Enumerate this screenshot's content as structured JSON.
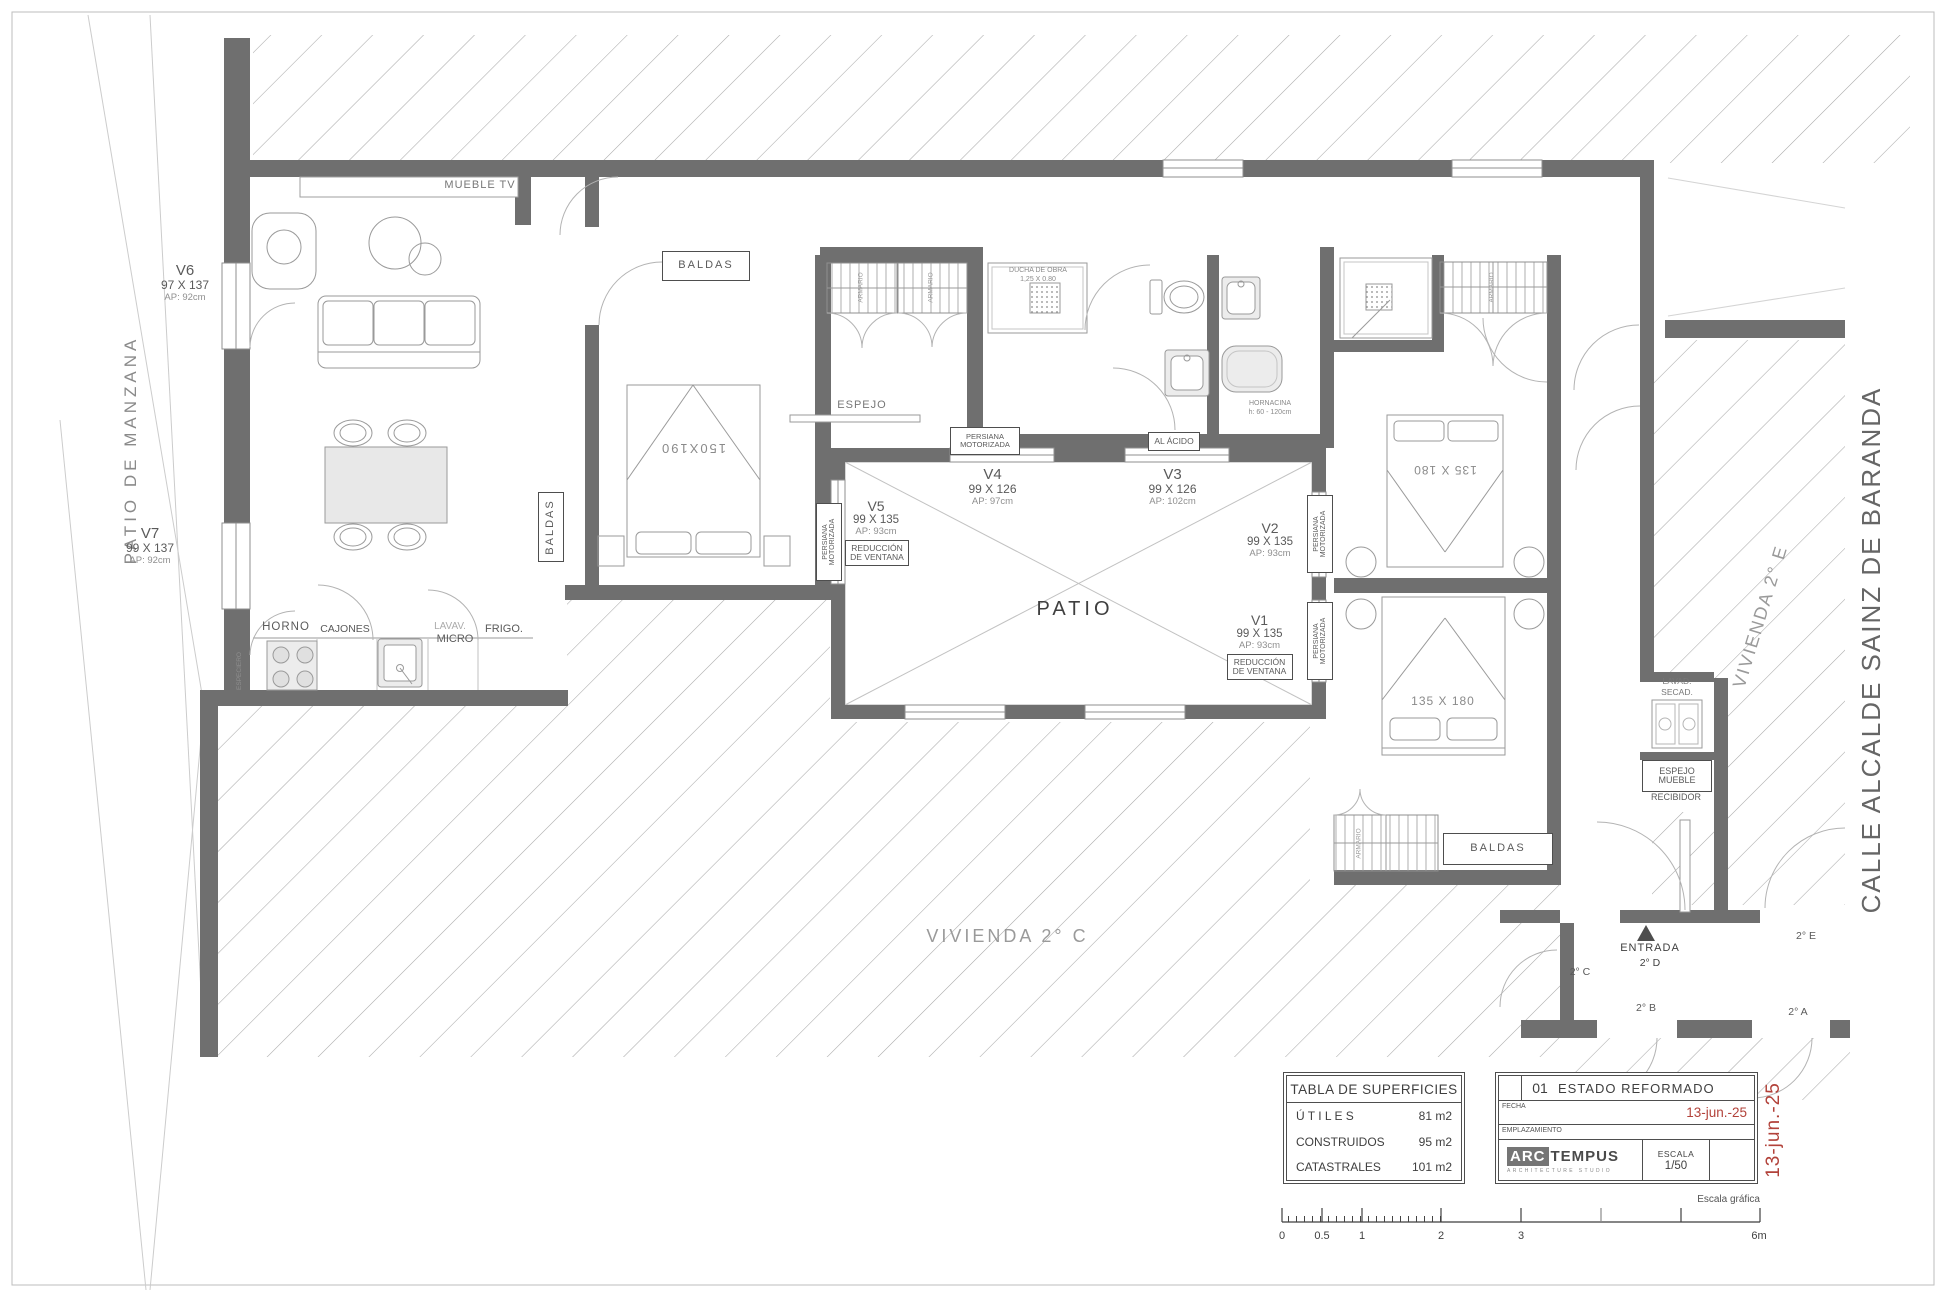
{
  "labels": {
    "patio_manzana": "PATIO DE MANZANA",
    "vivienda_c": "VIVIENDA 2° C",
    "vivienda_e": "VIVIENDA 2° E",
    "calle": "CALLE ALCALDE SAINZ DE BARANDA",
    "mueble_tv": "MUEBLE TV",
    "baldas": "BALDAS",
    "espejo": "ESPEJO",
    "patio": "PATIO",
    "entrada": "ENTRADA",
    "entrada_unit": "2° D",
    "unit_c": "2° C",
    "unit_e": "2° E",
    "unit_b": "2° B",
    "unit_a": "2° A",
    "armario": "ARMARIO",
    "especiero": "ESPECIERO",
    "horno": "HORNO",
    "cajones": "CAJONES",
    "lavav": "LAVAV.",
    "micro": "MICRO",
    "frigo": "FRIGO.",
    "bed_150": "150X190",
    "bed_135": "135 X 180",
    "ducha": "DUCHA DE OBRA",
    "ducha_dim": "1,25 X 0.80",
    "al_acido": "AL ÁCIDO",
    "hornacina": "HORNACINA",
    "hornacina_h": "h: 60 - 120cm",
    "persiana1": "PERSIANA",
    "persiana2": "MOTORIZADA",
    "reduccion1": "REDUCCIÓN",
    "reduccion2": "DE VENTANA",
    "lavad": "LAVAD.",
    "secad": "SECAD.",
    "espejo_mueble1": "ESPEJO",
    "espejo_mueble2": "MUEBLE",
    "recibidor": "RECIBIDOR"
  },
  "windows": {
    "v6": {
      "id": "V6",
      "dim": "97 X 137",
      "ap": "AP: 92cm"
    },
    "v7": {
      "id": "V7",
      "dim": "99 X 137",
      "ap": "AP: 92cm"
    },
    "v5": {
      "id": "V5",
      "dim": "99 X 135",
      "ap": "AP: 93cm"
    },
    "v4": {
      "id": "V4",
      "dim": "99 X 126",
      "ap": "AP: 97cm"
    },
    "v3": {
      "id": "V3",
      "dim": "99 X 126",
      "ap": "AP: 102cm"
    },
    "v2": {
      "id": "V2",
      "dim": "99 X 135",
      "ap": "AP: 93cm"
    },
    "v1": {
      "id": "V1",
      "dim": "99 X 135",
      "ap": "AP: 93cm"
    }
  },
  "surfaces": {
    "title": "TABLA DE SUPERFICIES",
    "rows": [
      {
        "k": "Ú T I L E S",
        "v": "81 m2"
      },
      {
        "k": "CONSTRUIDOS",
        "v": "95 m2"
      },
      {
        "k": "CATASTRALES",
        "v": "101 m2"
      }
    ]
  },
  "titleblock": {
    "num": "01",
    "name": "ESTADO REFORMADO",
    "fecha_label": "FECHA",
    "fecha": "13-jun.-25",
    "empl": "EMPLAZAMIENTO",
    "logo_a": "ARC",
    "logo_b": "TEMPUS",
    "logo_sub": "ARCHITECTURE STUDIO",
    "escala_label": "ESCALA",
    "escala": "1/50",
    "side_date": "13-jun.-25"
  },
  "scalebar": {
    "caption": "Escala gráfica",
    "t0": "0",
    "t05": "0.5",
    "t1": "1",
    "t2": "2",
    "t3": "3",
    "t6": "6m"
  }
}
